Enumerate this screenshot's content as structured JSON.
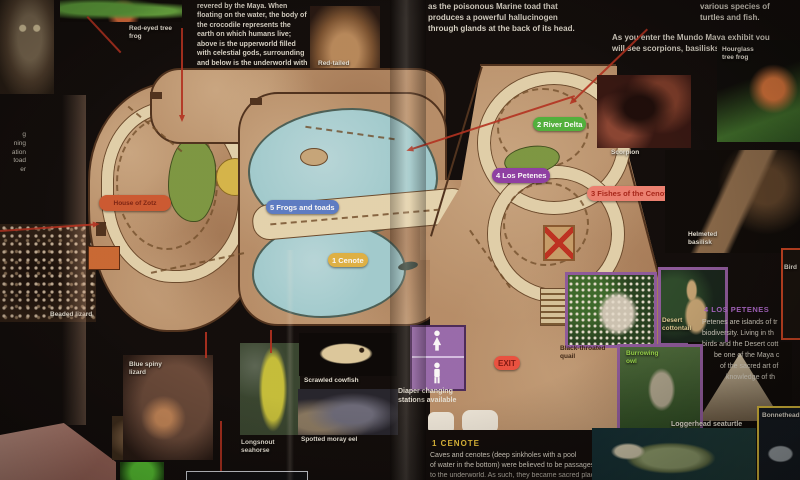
{
  "page": {
    "top_left_paragraph": "revered by the Maya. When floating on the water, the body of the crocodile represents the earth on which humans live; above is the upperworld filled with celestial gods, surrounding and below is the underworld with evil spirits.",
    "marine_toad_paragraph": "as the poisonous Marine toad that produces a powerful hallucinogen through glands at the back of its head.",
    "turtles_fragment": "various species of turtles and fish.",
    "entry_intro": "As you enter the Mundo Maya exhibit you will see scorpions, basilisks and frogs.",
    "left_edge_fragments": [
      "g",
      "ning",
      "ation",
      "toad",
      "er"
    ]
  },
  "map": {
    "area_labels": {
      "house_of_zotz": "House of Zotz",
      "frogs_and_toads": "5 Frogs and toads",
      "cenote": "1 Cenote",
      "river_delta": "2 River Delta",
      "los_petenes": "4 Los Petenes",
      "fishes_of_the_cenote": "3 Fishes of the Cenote"
    },
    "exit_label": "EXIT",
    "diaper_note": "Diaper changing stations available"
  },
  "photos": {
    "red_eyed_tree_frog": "Red-eyed tree frog",
    "red_tailed_boa": "Red-tailed boa",
    "beaded_lizard": "Beaded lizard",
    "blue_spiny_lizard": "Blue spiny lizard",
    "longsnout_seahorse": "Longsnout seahorse",
    "scrawled_cowfish": "Scrawled cowfish",
    "spotted_moray_eel": "Spotted moray eel",
    "scorpion": "Scorpion",
    "hourglass_tree_frog": "Hourglass tree frog",
    "helmeted_basilisk": "Helmeted basilisk",
    "black_throated_quail": "Black-throated quail",
    "desert_cottontail": "Desert cottontail",
    "burrowing_owl": "Burrowing owl",
    "loggerhead_seaturtle": "Loggerhead seaturtle",
    "bonnethead_shark": "Bonnethead shark",
    "cut_label_fragment": "Bird"
  },
  "articles": {
    "cenote": {
      "heading": "1 Cenote",
      "lines": [
        "Caves and cenotes (deep sinkholes with a pool",
        "of water in the bottom) were believed to be passages",
        "to the underworld. As such, they became sacred places"
      ]
    },
    "los_petenes": {
      "heading": "4 Los Petenes",
      "lines": [
        "Petenes are islands of tr",
        "biodiversity. Living in th",
        "birds and the Desert cott",
        "be one of the Maya c",
        "of the sacred art of",
        "knowledge of th"
      ]
    }
  },
  "colors": {
    "map_tan": "#b9906a",
    "water_blue": "#a3d0d4",
    "pill_green": "#4fb43c",
    "pill_purple": "#8f3fa8",
    "pill_salmon": "#f08273",
    "pill_blue": "#5b7ec9",
    "pill_yellow": "#e2b545",
    "exit_red": "#ee5140",
    "zotz_orange": "#cf5a31",
    "leader_red": "#b5301f",
    "photo_border_purple": "#8e5a9e",
    "photo_border_yellow": "#e0c23c"
  }
}
